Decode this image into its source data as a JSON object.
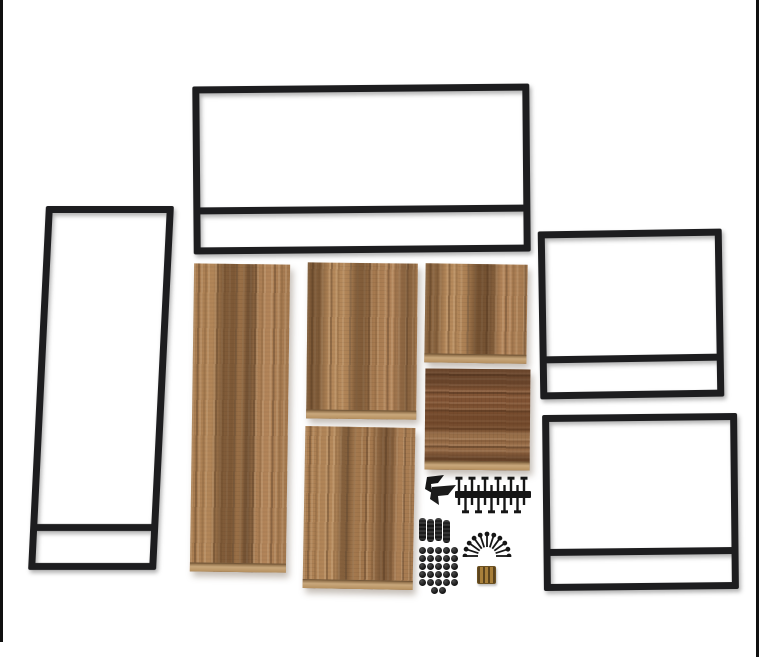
{
  "meta": {
    "description": "Flat-lay product photo on a white background showing the unassembled parts of an industrial-style furniture kit: one wide black metal frame, one tall black metal side frame, two square black metal side frames (each with a lower crossbar), five rustic brown wood panels, and assembly hardware (corner brackets, bolts, dowel pins, a fan of screws, cap nuts, brass threaded inserts). Thin black image-border lines are visible along the left and right edges."
  },
  "colors": {
    "background": "#ffffff",
    "image_border": "#101010",
    "metal": "#1d1d1f",
    "hardware": "#161616",
    "wood_base": "#a97c50",
    "wood_dark": "#6e4b2c",
    "wood_light": "#c09467",
    "wood_red": "#8a5a38",
    "board_edge": "#c9a87c",
    "brass": "#9c7430"
  },
  "scene": {
    "width": 759,
    "height": 657,
    "items": [
      {
        "kind": "vline",
        "name": "image-border-left",
        "x": 0,
        "y": 0,
        "w": 3,
        "h": 642
      },
      {
        "kind": "vline",
        "name": "image-border-right",
        "x": 756,
        "y": 0,
        "w": 3,
        "h": 657
      },
      {
        "kind": "frame",
        "name": "frame-top-wide",
        "x": 193,
        "y": 85,
        "w": 337,
        "h": 168,
        "tube": 7,
        "crossbar_y": 121,
        "transform": "rotate(-0.5deg)"
      },
      {
        "kind": "frame",
        "name": "frame-left-tall",
        "x": 37,
        "y": 206,
        "w": 128,
        "h": 364,
        "tube": 7,
        "crossbar_y": 318,
        "transform": "skewX(-2.8deg)"
      },
      {
        "kind": "frame",
        "name": "frame-right-upper",
        "x": 539,
        "y": 230,
        "w": 184,
        "h": 168,
        "tube": 7,
        "crossbar_y": 125,
        "transform": "rotate(-0.9deg)"
      },
      {
        "kind": "frame",
        "name": "frame-right-lower",
        "x": 543,
        "y": 414,
        "w": 195,
        "h": 176,
        "tube": 7,
        "crossbar_y": 134,
        "transform": "rotate(-0.6deg)"
      },
      {
        "kind": "panel",
        "name": "panel-large-left",
        "x": 192,
        "y": 264,
        "w": 96,
        "h": 308,
        "grain": "v",
        "variant": "a",
        "transform": "rotate(0.8deg)"
      },
      {
        "kind": "panel",
        "name": "panel-mid-upper",
        "x": 307,
        "y": 263,
        "w": 110,
        "h": 156,
        "grain": "v",
        "variant": "b",
        "transform": "rotate(0.6deg)"
      },
      {
        "kind": "panel",
        "name": "panel-mid-lower",
        "x": 304,
        "y": 427,
        "w": 110,
        "h": 162,
        "grain": "v",
        "variant": "c",
        "transform": "rotate(1deg)"
      },
      {
        "kind": "panel",
        "name": "panel-right-upper",
        "x": 425,
        "y": 264,
        "w": 102,
        "h": 99,
        "grain": "v",
        "variant": "d",
        "transform": "rotate(0.8deg)"
      },
      {
        "kind": "panel",
        "name": "panel-right-lower",
        "x": 425,
        "y": 369,
        "w": 105,
        "h": 101,
        "grain": "h",
        "variant": "e",
        "transform": "rotate(0.5deg)"
      },
      {
        "kind": "brackets",
        "name": "corner-brackets",
        "x": 420,
        "y": 474,
        "w": 38,
        "h": 32,
        "count": 2
      },
      {
        "kind": "boltcomb",
        "name": "cam-bolts-row",
        "x": 454,
        "y": 475,
        "w": 78,
        "h": 40,
        "count": 11
      },
      {
        "kind": "dowels",
        "name": "dowel-pins",
        "x": 419,
        "y": 518,
        "w": 33,
        "h": 25,
        "count": 4
      },
      {
        "kind": "screwfan",
        "name": "screw-fan",
        "x": 461,
        "y": 527,
        "w": 52,
        "h": 30,
        "count": 11
      },
      {
        "kind": "capgrid",
        "name": "cap-nuts-grid",
        "x": 419,
        "y": 547,
        "w": 40,
        "h": 48,
        "rows": 5,
        "cols": 5,
        "extra": 2
      },
      {
        "kind": "inserts",
        "name": "brass-inserts",
        "x": 477,
        "y": 566,
        "w": 17,
        "h": 16,
        "count": 3
      }
    ]
  }
}
